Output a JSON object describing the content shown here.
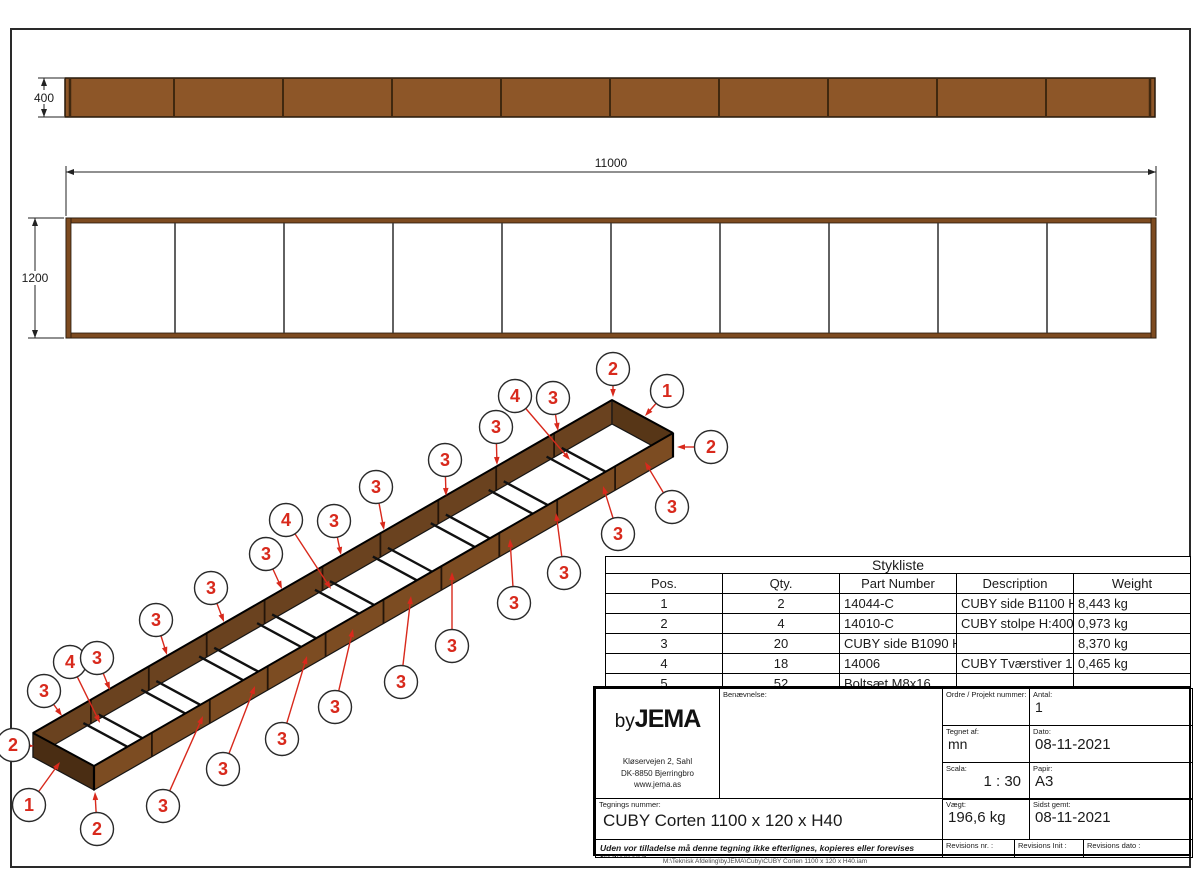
{
  "colors": {
    "corten": "#8d5628",
    "corten_edge": "#26180a",
    "divider": "#40280f",
    "plan_border": "#7d4b20",
    "plan_line": "#3a3a3a",
    "iso_far": "#6a421f",
    "iso_near": "#7c4c22",
    "iso_left_end": "#4a2d13",
    "iso_right_end": "#573617",
    "iso_edge": "#151515",
    "post": "#241509",
    "red": "#d8291c",
    "dim_line": "#222222"
  },
  "drawing": {
    "elevation": {
      "x": 65,
      "y": 78,
      "w": 1090,
      "h": 39,
      "bays": 10,
      "dim_height": "400"
    },
    "plan": {
      "x": 66,
      "y": 218,
      "w": 1090,
      "h": 120,
      "bays": 10,
      "band": 5,
      "dim_length": "11000",
      "dim_width": "1200"
    },
    "iso": {
      "origin": [
        33,
        733
      ],
      "bay": [
        57.9,
        -33.3
      ],
      "width_vec": [
        61,
        33
      ],
      "height_vec": [
        0,
        24
      ],
      "bays": 10,
      "brace_drop": 19,
      "brace_offset": 0.13
    },
    "balloons": [
      {
        "n": "3",
        "c": [
          44,
          691
        ],
        "t": [
          62,
          716
        ]
      },
      {
        "n": "4",
        "c": [
          70,
          662
        ],
        "t": [
          100,
          723
        ]
      },
      {
        "n": "3",
        "c": [
          97,
          658
        ],
        "t": [
          110,
          690
        ]
      },
      {
        "n": "3",
        "c": [
          156,
          620
        ],
        "t": [
          167,
          655
        ]
      },
      {
        "n": "3",
        "c": [
          211,
          588
        ],
        "t": [
          224,
          622
        ]
      },
      {
        "n": "3",
        "c": [
          266,
          554
        ],
        "t": [
          282,
          589
        ]
      },
      {
        "n": "4",
        "c": [
          286,
          520
        ],
        "t": [
          331,
          589
        ]
      },
      {
        "n": "3",
        "c": [
          334,
          521
        ],
        "t": [
          341,
          555
        ]
      },
      {
        "n": "3",
        "c": [
          376,
          487
        ],
        "t": [
          384,
          530
        ]
      },
      {
        "n": "3",
        "c": [
          445,
          460
        ],
        "t": [
          446,
          496
        ]
      },
      {
        "n": "3",
        "c": [
          496,
          427
        ],
        "t": [
          497,
          465
        ]
      },
      {
        "n": "4",
        "c": [
          515,
          396
        ],
        "t": [
          570,
          460
        ]
      },
      {
        "n": "3",
        "c": [
          553,
          398
        ],
        "t": [
          558,
          431
        ]
      },
      {
        "n": "2",
        "c": [
          613,
          369
        ],
        "t": [
          613,
          397
        ]
      },
      {
        "n": "1",
        "c": [
          667,
          391
        ],
        "t": [
          645,
          416
        ]
      },
      {
        "n": "2",
        "c": [
          711,
          447
        ],
        "t": [
          677,
          447
        ]
      },
      {
        "n": "3",
        "c": [
          672,
          507
        ],
        "t": [
          645,
          462
        ]
      },
      {
        "n": "3",
        "c": [
          618,
          534
        ],
        "t": [
          603,
          486
        ]
      },
      {
        "n": "3",
        "c": [
          564,
          573
        ],
        "t": [
          556,
          513
        ]
      },
      {
        "n": "3",
        "c": [
          514,
          603
        ],
        "t": [
          510,
          539
        ]
      },
      {
        "n": "3",
        "c": [
          452,
          646
        ],
        "t": [
          452,
          572
        ]
      },
      {
        "n": "3",
        "c": [
          401,
          682
        ],
        "t": [
          411,
          596
        ]
      },
      {
        "n": "3",
        "c": [
          335,
          707
        ],
        "t": [
          353,
          629
        ]
      },
      {
        "n": "3",
        "c": [
          282,
          739
        ],
        "t": [
          307,
          656
        ]
      },
      {
        "n": "3",
        "c": [
          223,
          769
        ],
        "t": [
          255,
          686
        ]
      },
      {
        "n": "3",
        "c": [
          163,
          806
        ],
        "t": [
          203,
          716
        ]
      },
      {
        "n": "2",
        "c": [
          97,
          829
        ],
        "t": [
          95,
          792
        ]
      },
      {
        "n": "1",
        "c": [
          29,
          805
        ],
        "t": [
          60,
          762
        ]
      },
      {
        "n": "2",
        "c": [
          13,
          745
        ],
        "t": [
          34,
          746
        ]
      }
    ]
  },
  "parts_table": {
    "title": "Stykliste",
    "headers": [
      "Pos.",
      "Qty.",
      "Part Number",
      "Description",
      "Weight"
    ],
    "col_widths": [
      37,
      39,
      171,
      185,
      154
    ],
    "rows": [
      [
        "1",
        "2",
        "14044-C",
        "CUBY side B1100 H400 Corten",
        "8,443 kg"
      ],
      [
        "2",
        "4",
        "14010-C",
        "CUBY stolpe H:400 Corten",
        "0,973 kg"
      ],
      [
        "3",
        "20",
        "CUBY side B1090 H400",
        "",
        "8,370 kg"
      ],
      [
        "4",
        "18",
        "14006",
        "CUBY Tværstiver 1200 Galva",
        "0,465 kg"
      ],
      [
        "5",
        "52",
        "Boltsæt M8x16",
        "",
        ""
      ]
    ]
  },
  "title_block": {
    "logo_by": "by",
    "logo_jema": "JEMA",
    "address_line1": "Kløservejen 2, Sahl",
    "address_line2": "DK-8850 Bjerringbro",
    "address_line3": "www.jema.as",
    "benaevnelse_label": "Benævnelse:",
    "ordre_label": "Ordre / Projekt nummer:",
    "antal_label": "Antal:",
    "antal_value": "1",
    "tegnet_label": "Tegnet af:",
    "tegnet_value": "mn",
    "dato_label": "Dato:",
    "dato_value": "08-11-2021",
    "scala_label": "Scala:",
    "scala_value": "1 : 30",
    "papir_label": "Papir:",
    "papir_value": "A3",
    "tegnings_label": "Tegnings nummer:",
    "tegnings_value": "CUBY Corten 1100 x 120 x H40",
    "vaegt_label": "Vægt:",
    "vaegt_value": "196,6 kg",
    "sidst_label": "Sidst gemt:",
    "sidst_value": "08-11-2021",
    "rev_nr_label": "Revisions nr. :",
    "rev_init_label": "Revisions Init :",
    "rev_dato_label": "Revisions dato :",
    "disclaimer": "Uden vor tilladelse må denne tegning ikke efterlignes, kopieres eller forevises tredjemand",
    "file_path": "M:\\Teknisk Afdeling\\byJEMA\\Cuby\\CUBY Corten 1100 x 120 x H40.iam"
  }
}
